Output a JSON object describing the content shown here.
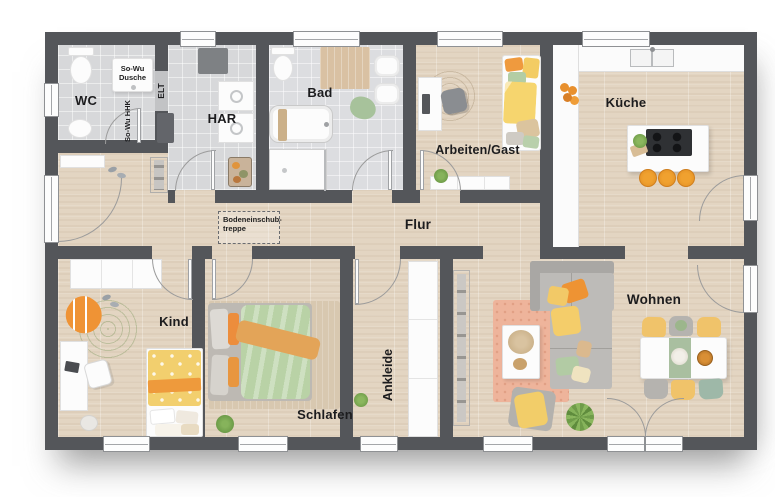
{
  "rooms": {
    "wc": "WC",
    "har": "HAR",
    "bad": "Bad",
    "arbeiten_gast": "Arbeiten/Gast",
    "kueche": "Küche",
    "flur": "Flur",
    "kind": "Kind",
    "schlafen": "Schlafen",
    "ankleide": "Ankleide",
    "wohnen": "Wohnen"
  },
  "annotations": {
    "shower_line1": "So-Wu",
    "shower_line2": "Dusche",
    "elt": "ELT",
    "hhk": "So-Wu HHK",
    "attic_line1": "Bodeneinschub-",
    "attic_line2": "treppe"
  },
  "colors": {
    "wall": "#54565a",
    "wood_floor": "#e3d5c2",
    "tile_floor": "#d7d8da",
    "accent_orange": "#ee9a3d",
    "accent_yellow": "#f2cf6e",
    "accent_green": "#b7d0a5",
    "accent_salmon": "#eeb49b",
    "rug_green": "#a8c389"
  }
}
